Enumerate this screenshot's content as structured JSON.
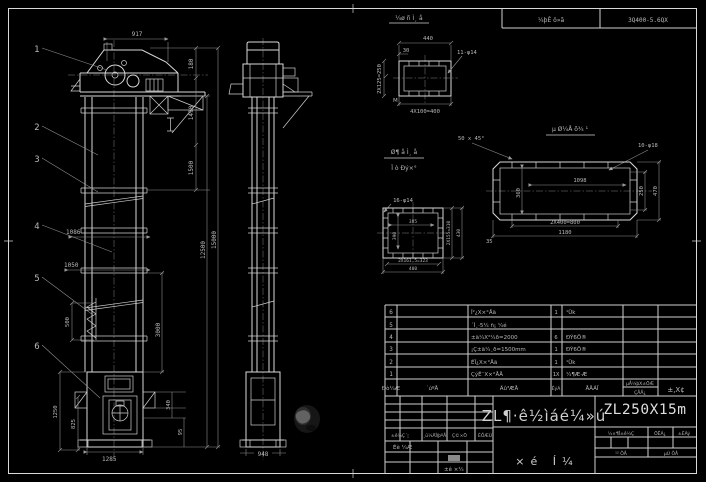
{
  "page": {
    "bg": "#000000",
    "line_color": "#d9d9d9",
    "dim_color": "#8e8e8e",
    "text_color": "#b9b9b9"
  },
  "header": {
    "doc_label": "¼þÊ ö»ã",
    "doc_number": "3Q400-5.6QX"
  },
  "front_view": {
    "balloons": [
      "1",
      "2",
      "3",
      "4",
      "5",
      "6"
    ],
    "dims": {
      "top_width": "917",
      "head_h1": "180",
      "head_h2": "1490",
      "section_top": "1500",
      "overall_height": "15000",
      "mid_height": "12500",
      "lower_section": "3000",
      "inlet_w": "1086",
      "inlet_w2": "1050",
      "bucket_pitch": "500",
      "boot_h": "1250",
      "boot_door_h": "825",
      "boot_side": "340",
      "boot_foot": "95",
      "boot_width": "1285"
    }
  },
  "side_view": {
    "dims": {
      "depth": "948"
    }
  },
  "detail_top": {
    "title": "¼ø ñ Ì¸ å",
    "dims": {
      "w": "440",
      "offset": "30",
      "holes": "11-φ14",
      "left": "2X125=250",
      "bottom": "4X100=400",
      "mark": "M"
    }
  },
  "detail_mid": {
    "title1": "Ø¶ å Ì¸ å",
    "title2": "Ï ò Ðý×°",
    "dims": {
      "holes": "16-φ14",
      "inner_w": "385",
      "inner_h": "390",
      "right1": "2X155=310",
      "right2": "430",
      "bottom1": "2X161.5=323",
      "bottom2": "400"
    }
  },
  "detail_base": {
    "title": "µ Ø¼Å õ¾ ¹",
    "dims": {
      "chamfer": "50 x 45°",
      "holes": "10-φ18",
      "inner": "1098",
      "left": "360",
      "right1": "250",
      "right2": "470",
      "bottom1": "2X400=800",
      "bottom2": "1180",
      "edge": "35"
    }
  },
  "bom": {
    "rows": [
      {
        "no": "6",
        "code": "",
        "name": "Î²¿X×°Åä",
        "qty": "1",
        "mat": "¹Ük"
      },
      {
        "no": "5",
        "code": "",
        "name": "´Ì¸·5¼ ñ¡ ¼é",
        "qty": "",
        "mat": ""
      },
      {
        "no": "4",
        "code": "",
        "name": "±ä¼X²¼ð=2000",
        "qty": "6",
        "mat": "ÐÝ6Ö®"
      },
      {
        "no": "3",
        "code": "",
        "name": "¡Ç±ä¼¸ð=1500mm",
        "qty": "1",
        "mat": "ÐÝ6Ö®"
      },
      {
        "no": "2",
        "code": "",
        "name": "ÉÏ¿X×°Åä",
        "qty": "1",
        "mat": "¹Ük"
      },
      {
        "no": "1",
        "code": "",
        "name": "ÇýÊ¯X×°ÅÄ",
        "qty": "1X",
        "mat": "¼¶Æ·Æ"
      }
    ],
    "header": {
      "no": "Ðò¼Æ",
      "code": "´úºÅ",
      "name": "Ãû³ÆÅ",
      "qty": "ÊýÁ",
      "mat": "ÅÄÁÏ",
      "w1": "µÅ¼þX±ÖÆ",
      "w2": "ÇÅÅ¿",
      "note": "±,X¢"
    }
  },
  "titleblock": {
    "rev_header": [
      "±ê¼Ç´¦",
      "¸ü¼ÄÎļþºÅ",
      "Ç©×Ö",
      "ÈÕÆÚ"
    ],
    "sig1": "Éè ¼Æ",
    "sig2": "±ê ×¼",
    "product_name": "ZL¶·ê½ìáé¼»ú",
    "model": "ZL250X15m",
    "stage": "½×¶Î±ê¼Ç",
    "mass": "ÖÊÁ¿",
    "scale": "±ÈÀý",
    "sheet_total": "¹² ÕÅ",
    "sheet_no": "µÚ ÕÅ",
    "drawing_type": "×é  Í¼"
  }
}
